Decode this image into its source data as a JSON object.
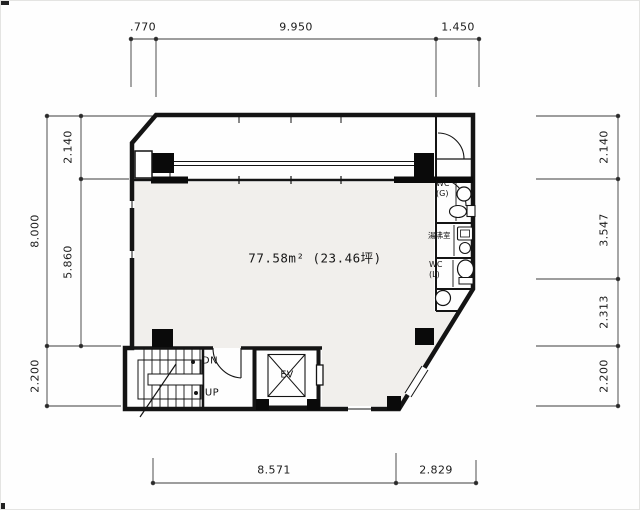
{
  "drawing_type": "floor-plan",
  "area_label": "77.58m² (23.46坪)",
  "dimensions": {
    "top": [
      ".770",
      "9.950",
      "1.450"
    ],
    "left": {
      "outer": [
        "8.000",
        "2.200"
      ],
      "inner": [
        "2.140",
        "5.860"
      ]
    },
    "right": [
      "2.140",
      "3.547",
      "2.313",
      "2.200"
    ],
    "bottom": [
      "8.571",
      "2.829"
    ]
  },
  "core": {
    "down": "DN",
    "up": "UP",
    "elevator": "EV"
  },
  "rooms": {
    "wc_g": {
      "l1": "WC",
      "l2": "(G)"
    },
    "kitchenette": "湯沸室",
    "wc_l": {
      "l1": "WC",
      "l2": "(L)"
    }
  },
  "colors": {
    "wall": "#141414",
    "dimension_line": "#3c3c3c",
    "floor_fill": "#f1efec"
  }
}
